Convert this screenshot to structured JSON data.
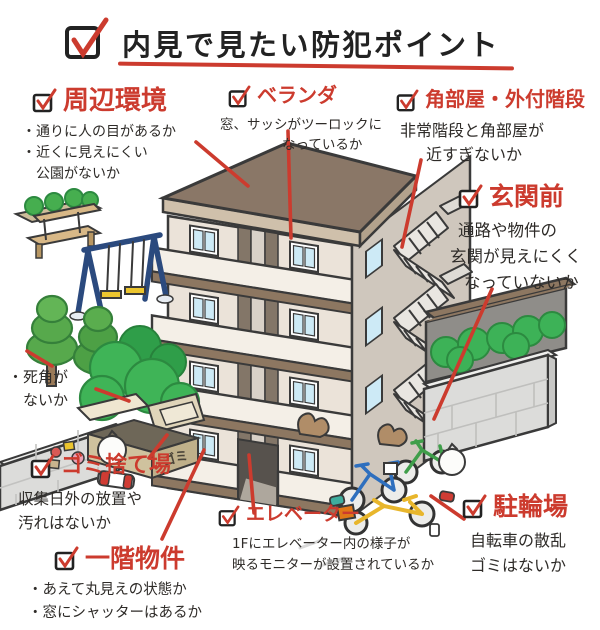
{
  "title": "内見で見たい防犯ポイント",
  "colors": {
    "annotation_red": "#cc3b2e",
    "roof_brown": "#8a7767",
    "wall_cream": "#ebe3d9"
  },
  "sections": {
    "surroundings": {
      "heading": "周辺環境",
      "lines": [
        "・通りに人の目があるか",
        "・近くに見えにくい",
        "　公園がないか"
      ]
    },
    "veranda": {
      "heading": "ベランダ",
      "lines": [
        "窓、サッシがツーロックに",
        "なっているか"
      ]
    },
    "corner_room": {
      "heading": "角部屋・外付階段",
      "lines": [
        "非常階段と角部屋が",
        "近すぎないか"
      ]
    },
    "entrance_front": {
      "heading": "玄関前",
      "lines": [
        "通路や物件の",
        "玄関が見えにくく",
        "なっていないか"
      ]
    },
    "blind_spot": {
      "lines": [
        "・死角が",
        "　ないか"
      ]
    },
    "garbage_area": {
      "heading": "ゴミ捨て場",
      "lines": [
        "収集日外の放置や",
        "汚れはないか"
      ]
    },
    "first_floor": {
      "heading": "一階物件",
      "lines": [
        "・あえて丸見えの状態か",
        "・窓にシャッターはあるか"
      ]
    },
    "elevator": {
      "heading": "エレベーター",
      "lines": [
        "1Fにエレベーター内の様子が",
        "映るモニターが設置されているか"
      ]
    },
    "bicycle_parking": {
      "heading": "駐輪場",
      "lines": [
        "自転車の散乱",
        "ゴミはないか"
      ]
    }
  },
  "illustration": {
    "garbage_label": "ゴミ"
  }
}
